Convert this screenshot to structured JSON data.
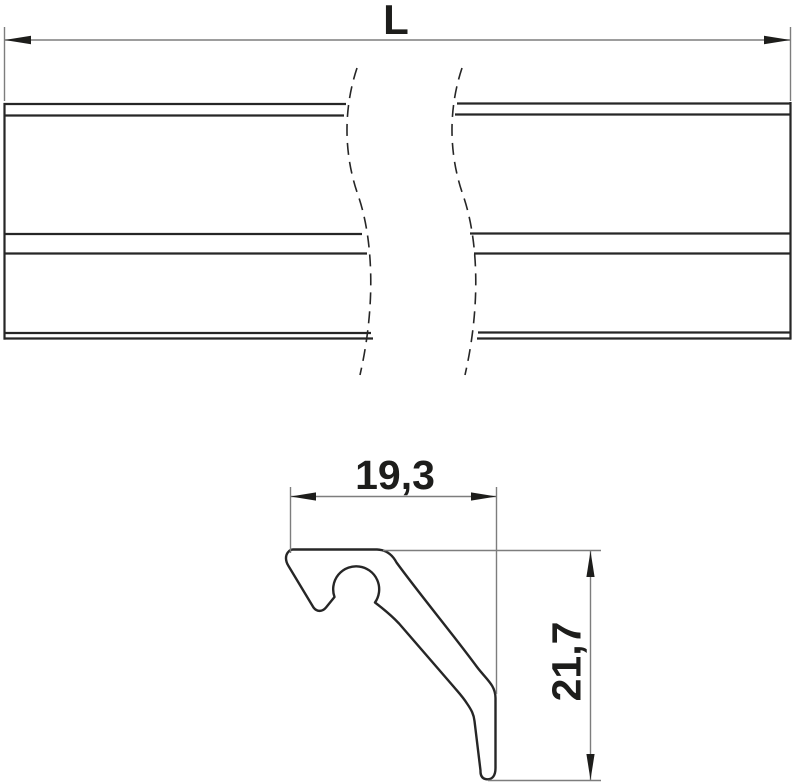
{
  "drawing": {
    "top_view": {
      "length_label": "L"
    },
    "cross_section": {
      "width_label": "19,3",
      "height_label": "21,7"
    },
    "colors": {
      "outline": "#262626",
      "dimension_line": "#7d7d7d",
      "arrow": "#1d1d1b",
      "background": "#ffffff"
    }
  }
}
